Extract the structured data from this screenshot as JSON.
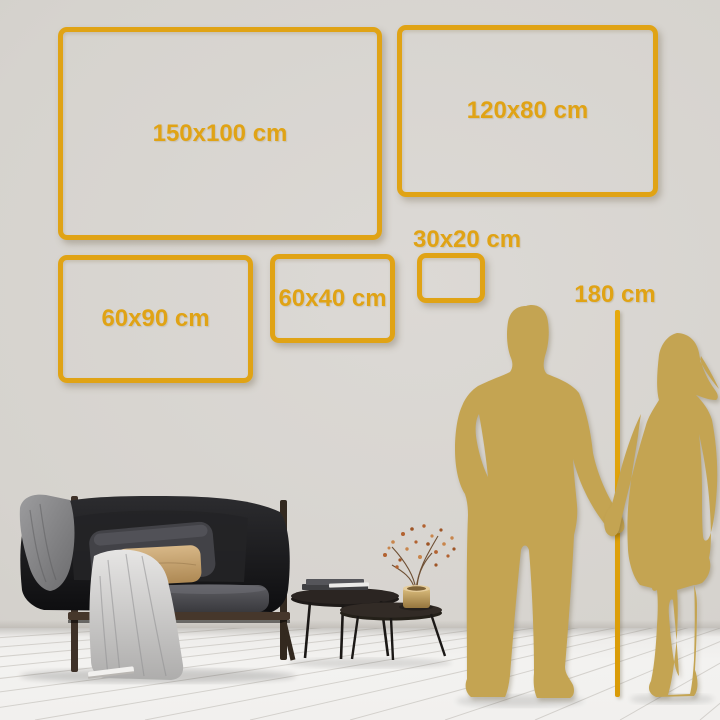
{
  "frames": [
    {
      "id": "150x100",
      "label": "150x100 cm"
    },
    {
      "id": "120x80",
      "label": "120x80 cm"
    },
    {
      "id": "60x90",
      "label": "60x90 cm"
    },
    {
      "id": "60x40",
      "label": "60x40 cm"
    },
    {
      "id": "30x20",
      "label": "30x20 cm"
    }
  ],
  "reference": {
    "height_label": "180 cm"
  },
  "colors": {
    "accent_gold": "#E0A315",
    "silhouette_gold": "#C4A452",
    "wall": "#D7D4CF",
    "floor": "#F1F0EE"
  }
}
